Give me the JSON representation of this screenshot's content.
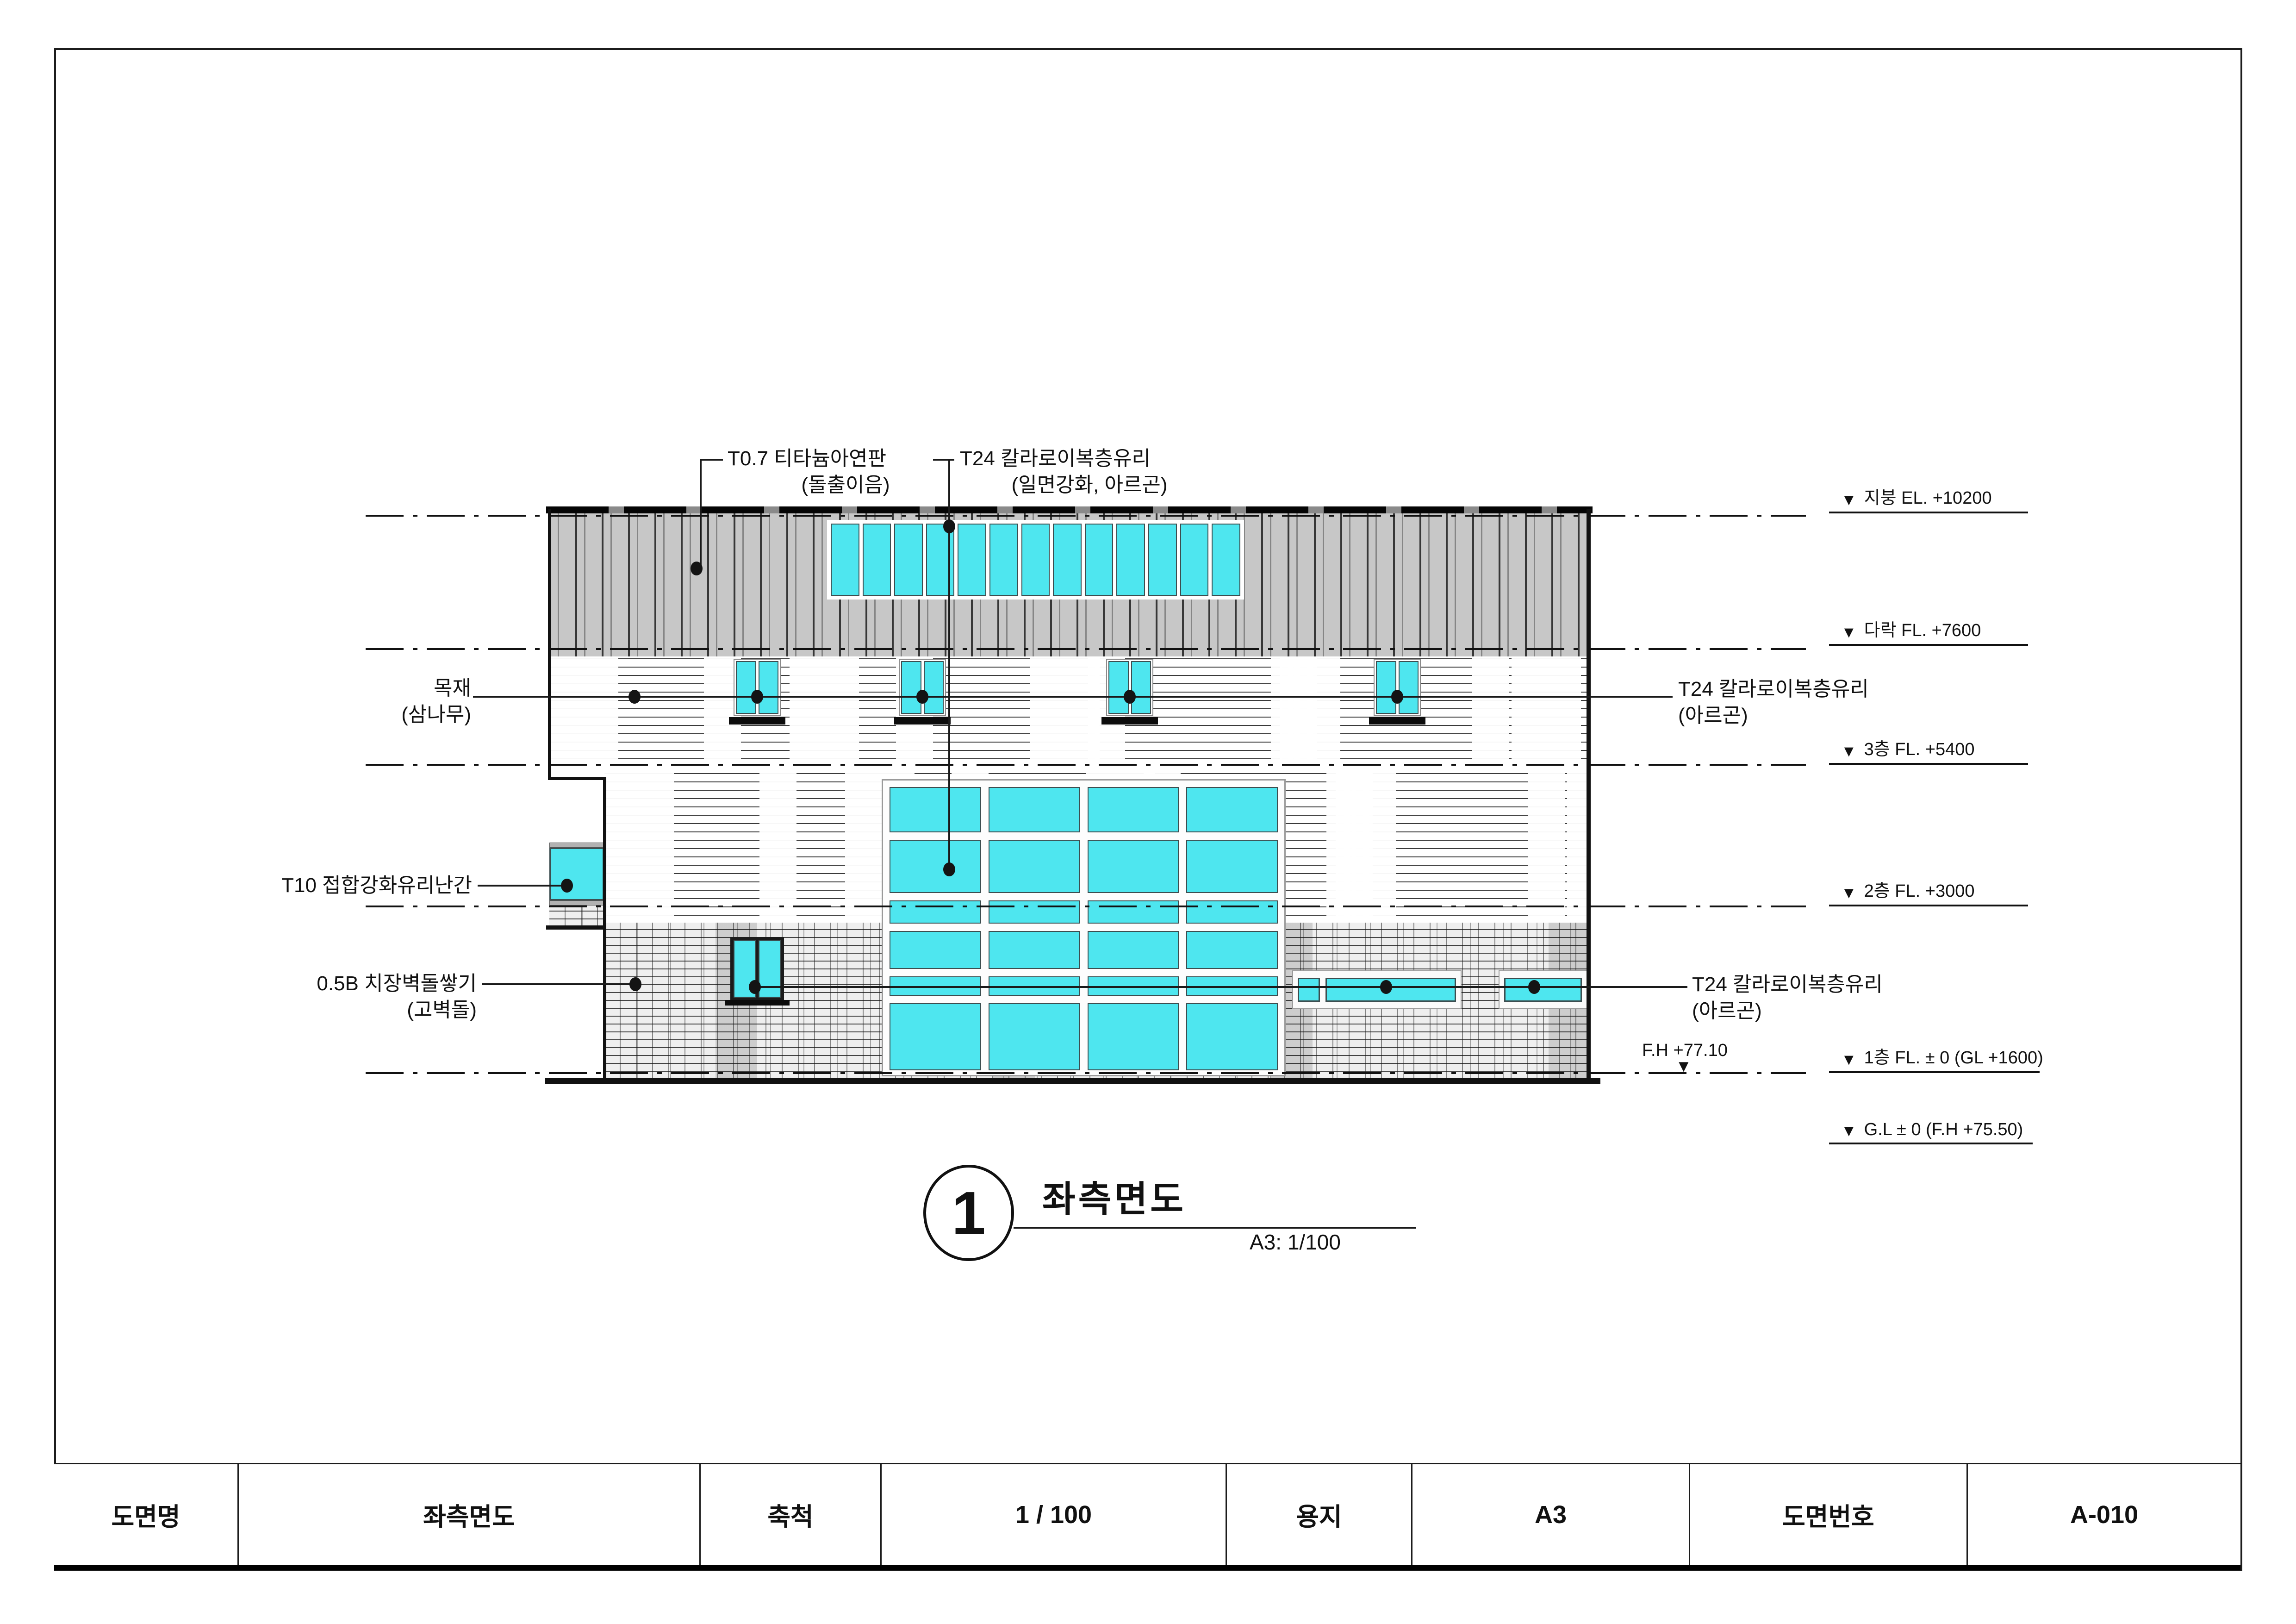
{
  "annotations": {
    "roof_panel": {
      "line1": "T0.7 티타늄아연판",
      "line2": "(돌출이음)"
    },
    "glass_top": {
      "line1": "T24 칼라로이복층유리",
      "line2": "(일면강화, 아르곤)"
    },
    "wood": {
      "line1": "목재",
      "line2": "(삼나무)"
    },
    "railing": {
      "line1": "T10 접합강화유리난간"
    },
    "brick": {
      "line1": "0.5B 치장벽돌쌓기",
      "line2": "(고벽돌)"
    },
    "glass_mid": {
      "line1": "T24 칼라로이복층유리",
      "line2": "(아르곤)"
    },
    "glass_bottom": {
      "line1": "T24 칼라로이복층유리",
      "line2": "(아르곤)"
    },
    "finish_height": "F.H +77.10"
  },
  "levels": {
    "roof": "지붕 EL. +10200",
    "attic": "다락 FL. +7600",
    "f3": "3층 FL. +5400",
    "f2": "2층 FL. +3000",
    "f1": "1층 FL. ± 0  (GL +1600)",
    "gl": "G.L ± 0 (F.H +75.50)"
  },
  "title_callout": {
    "number": "1",
    "title": "좌측면도",
    "scale": "A3:  1/100"
  },
  "title_block": {
    "cells": [
      "도면명",
      "좌측면도",
      "축척",
      "1 / 100",
      "용지",
      "A3",
      "도면번호",
      "A-010"
    ]
  },
  "colors": {
    "glass": "#4ee6ef",
    "roof_panel_gray": "#c7c7c7",
    "line": "#111111"
  },
  "drawing_type": "left side elevation (좌측면도), scale 1/100, sheet A3, drawing no. A-010"
}
